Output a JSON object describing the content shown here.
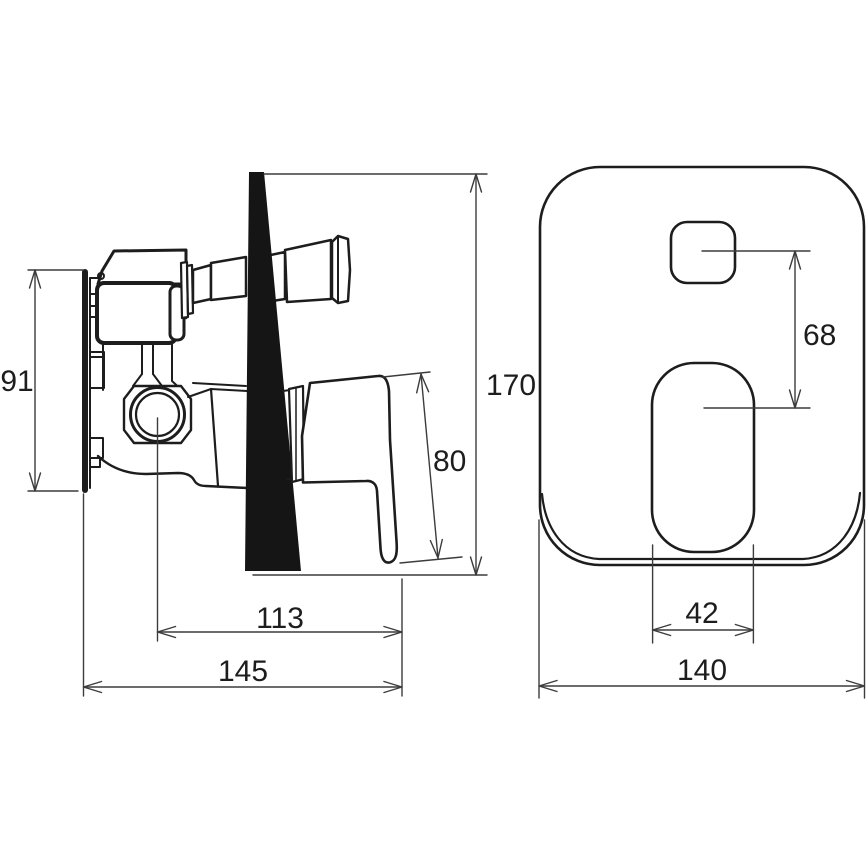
{
  "drawing": {
    "kind": "technical dimension drawing",
    "subject": "concealed single-lever shower mixer - side section and front trim plate views",
    "unit_system": "mm",
    "ink_color": "#1d1d1d",
    "paper_color": "#ffffff"
  },
  "side_view": {
    "rough_in_body_height": "91",
    "overall_height": "170",
    "lever_length": "80",
    "lever_tip_offset": "113",
    "overall_depth": "145"
  },
  "front_view": {
    "control_centers_distance": "68",
    "lever_opening_width": "42",
    "plate_width": "140"
  }
}
